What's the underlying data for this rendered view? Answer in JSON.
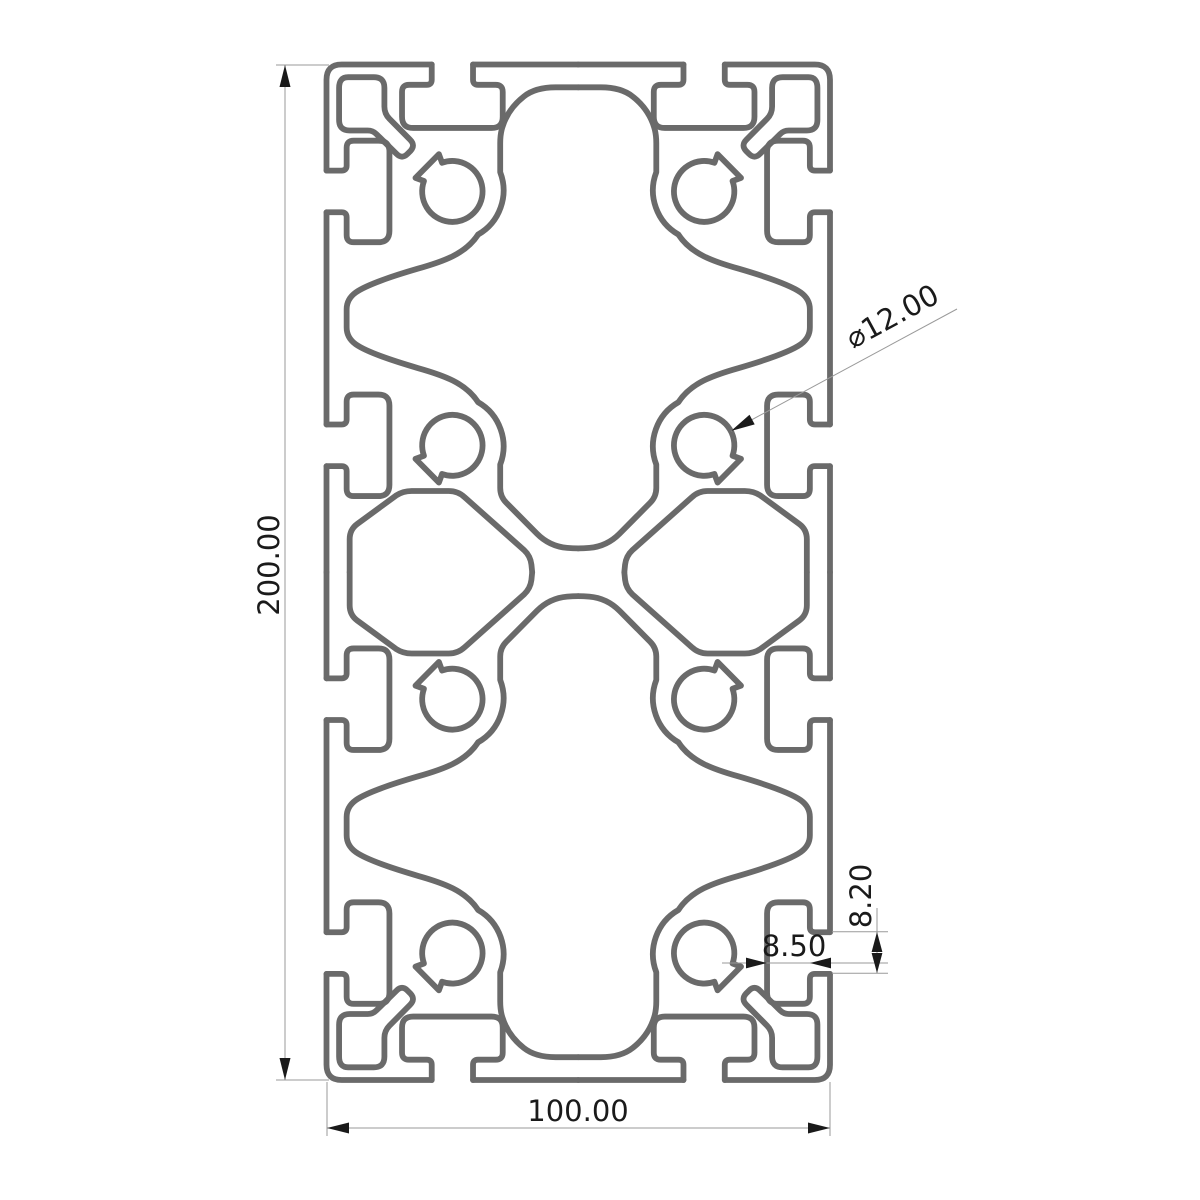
{
  "drawing": {
    "type": "technical-cross-section",
    "subject": "aluminium-extrusion-profile-100x200-t-slot",
    "dims": {
      "height": {
        "label": "200.00",
        "orientation": "vertical-left"
      },
      "width": {
        "label": "100.00",
        "orientation": "horizontal-bottom"
      },
      "bore_diameter": {
        "label": "⌀12.00",
        "orientation": "diagonal-leader"
      },
      "slot_cavity_depth": {
        "label": "8.50",
        "orientation": "horizontal"
      },
      "slot_opening": {
        "label": "8.20",
        "orientation": "vertical"
      }
    },
    "colors": {
      "background": "#ffffff",
      "profile_line": "#6a6a6a",
      "dimension_line": "#9a9a9a",
      "annotation": "#1a1a1a"
    }
  }
}
